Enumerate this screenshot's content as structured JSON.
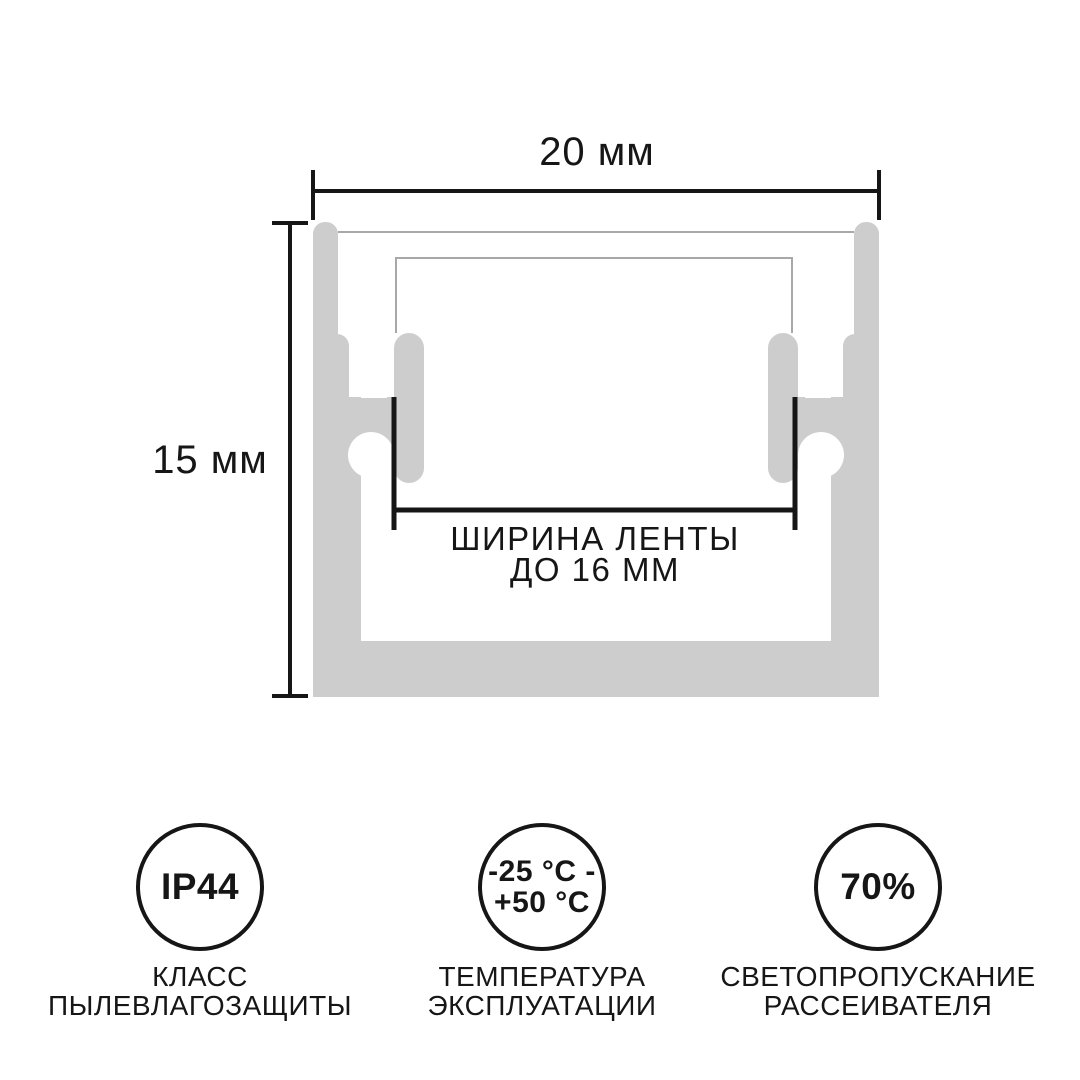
{
  "diagram": {
    "width_dim": "20 мм",
    "height_dim": "15 мм",
    "strip_width_lines": [
      "ШИРИНА ЛЕНТЫ",
      "ДО 16 ММ"
    ]
  },
  "badges": [
    {
      "name": "ip-rating",
      "value_lines": [
        "IP44"
      ],
      "label_lines": [
        "КЛАСС",
        "ПЫЛЕВЛАГОЗАЩИТЫ"
      ]
    },
    {
      "name": "operating-temperature",
      "value_lines": [
        "-25 °C -",
        "+50 °C"
      ],
      "label_lines": [
        "ТЕМПЕРАТУРА",
        "ЭКСПЛУАТАЦИИ"
      ]
    },
    {
      "name": "light-transmission",
      "value_lines": [
        "70%"
      ],
      "label_lines": [
        "СВЕТОПРОПУСКАНИЕ",
        "РАССЕИВАТЕЛЯ"
      ]
    }
  ],
  "colors": {
    "profile_fill": "#cdcdcd",
    "thin_line": "#a8a8a8",
    "ink": "#161616",
    "background": "#ffffff"
  }
}
